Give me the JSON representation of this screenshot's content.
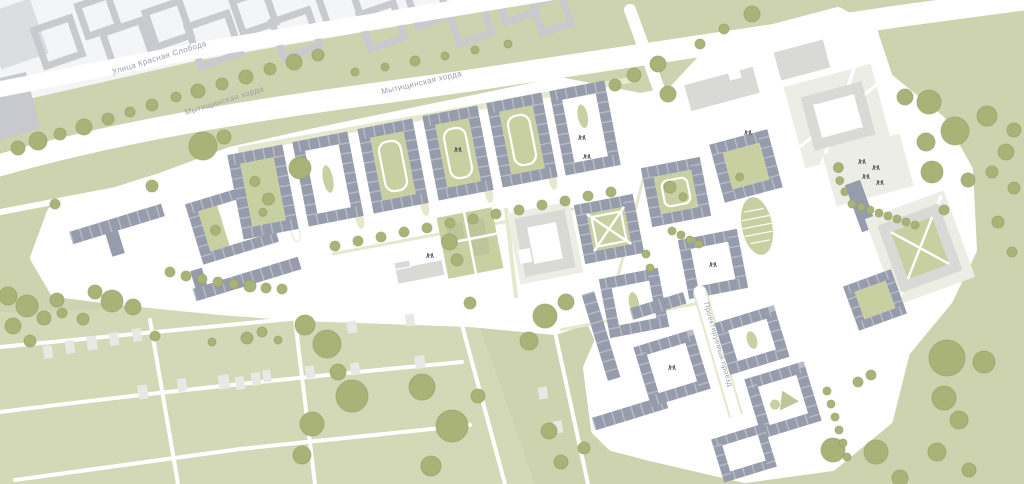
{
  "streets": [
    {
      "name": "Улица Красная Слобода"
    },
    {
      "name": "Мытищинская хорда"
    },
    {
      "name": "Мытищинская хорда"
    },
    {
      "name": "Проектируемый проезд"
    }
  ],
  "icons": [
    {
      "name": "playground-icon",
      "shape": "two small human figures"
    }
  ],
  "palette": {
    "bg": "#cdd3ae",
    "bgLight": "#d3d8b7",
    "site": "#ffffff",
    "road": "#ffffff",
    "building": "#979cac",
    "court": "#c8cfa1",
    "median": "#e4e8cc",
    "tree": "#a9b377",
    "treeEdge": "#8f9d63",
    "public": "#d9dad6",
    "plot": "#ecede4",
    "existing": "#c8cacf",
    "existingBg": "#f4f5f6",
    "existingFill": "#dcdde1",
    "house": "#e8e9e4",
    "parkBed": "#bcc69a",
    "label": "#98a1a3",
    "icon": "#444953"
  }
}
